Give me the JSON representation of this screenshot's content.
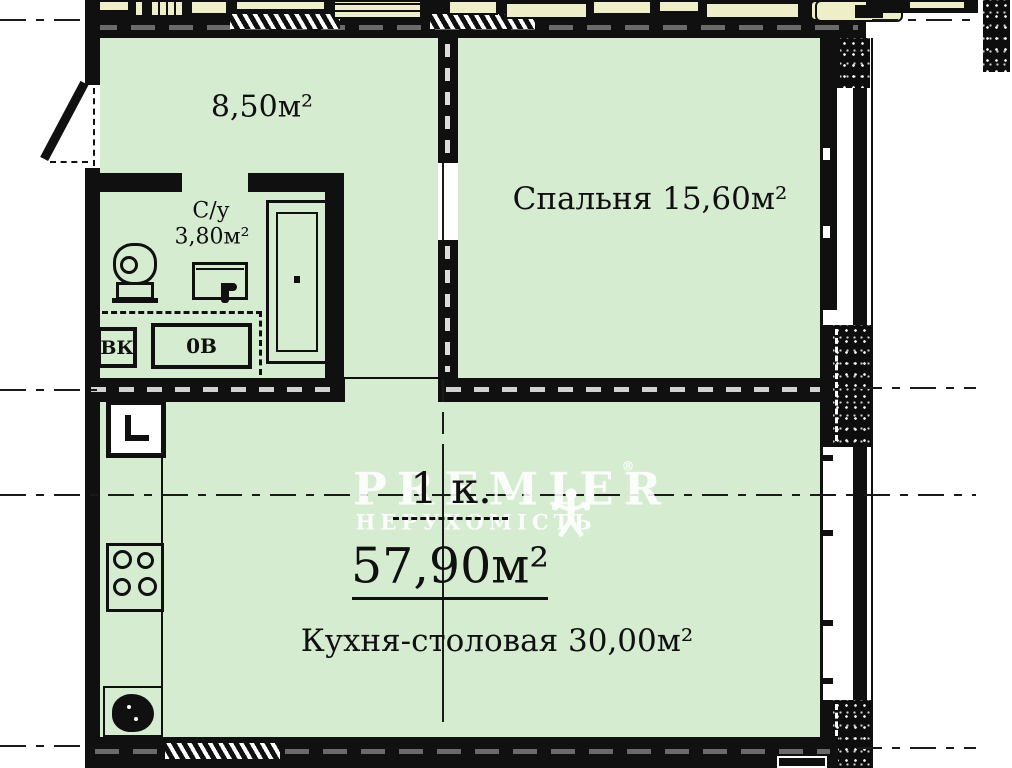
{
  "plan": {
    "type": "apartment-floor-plan",
    "summary": {
      "rooms": "1 к.",
      "total_area": "57,90м²"
    },
    "rooms": {
      "hallway": {
        "area": "8,50м²"
      },
      "bedroom": {
        "label": "Спальня 15,60м²"
      },
      "bathroom": {
        "name": "С/у",
        "area": "3,80м²"
      },
      "kitchen": {
        "label": "Кухня-столовая 30,00м²"
      }
    },
    "shafts": {
      "vk": "ВК",
      "ov": "0В"
    },
    "watermark": {
      "brand": "PREMIER",
      "reg": "®",
      "subtitle": "НЕРУХОМІСТЬ"
    },
    "colors": {
      "room_fill": "#d6ecd1",
      "wall": "#101010",
      "neighbor_fill": "#eeeec9",
      "watermark_white": "#ffffff"
    }
  }
}
